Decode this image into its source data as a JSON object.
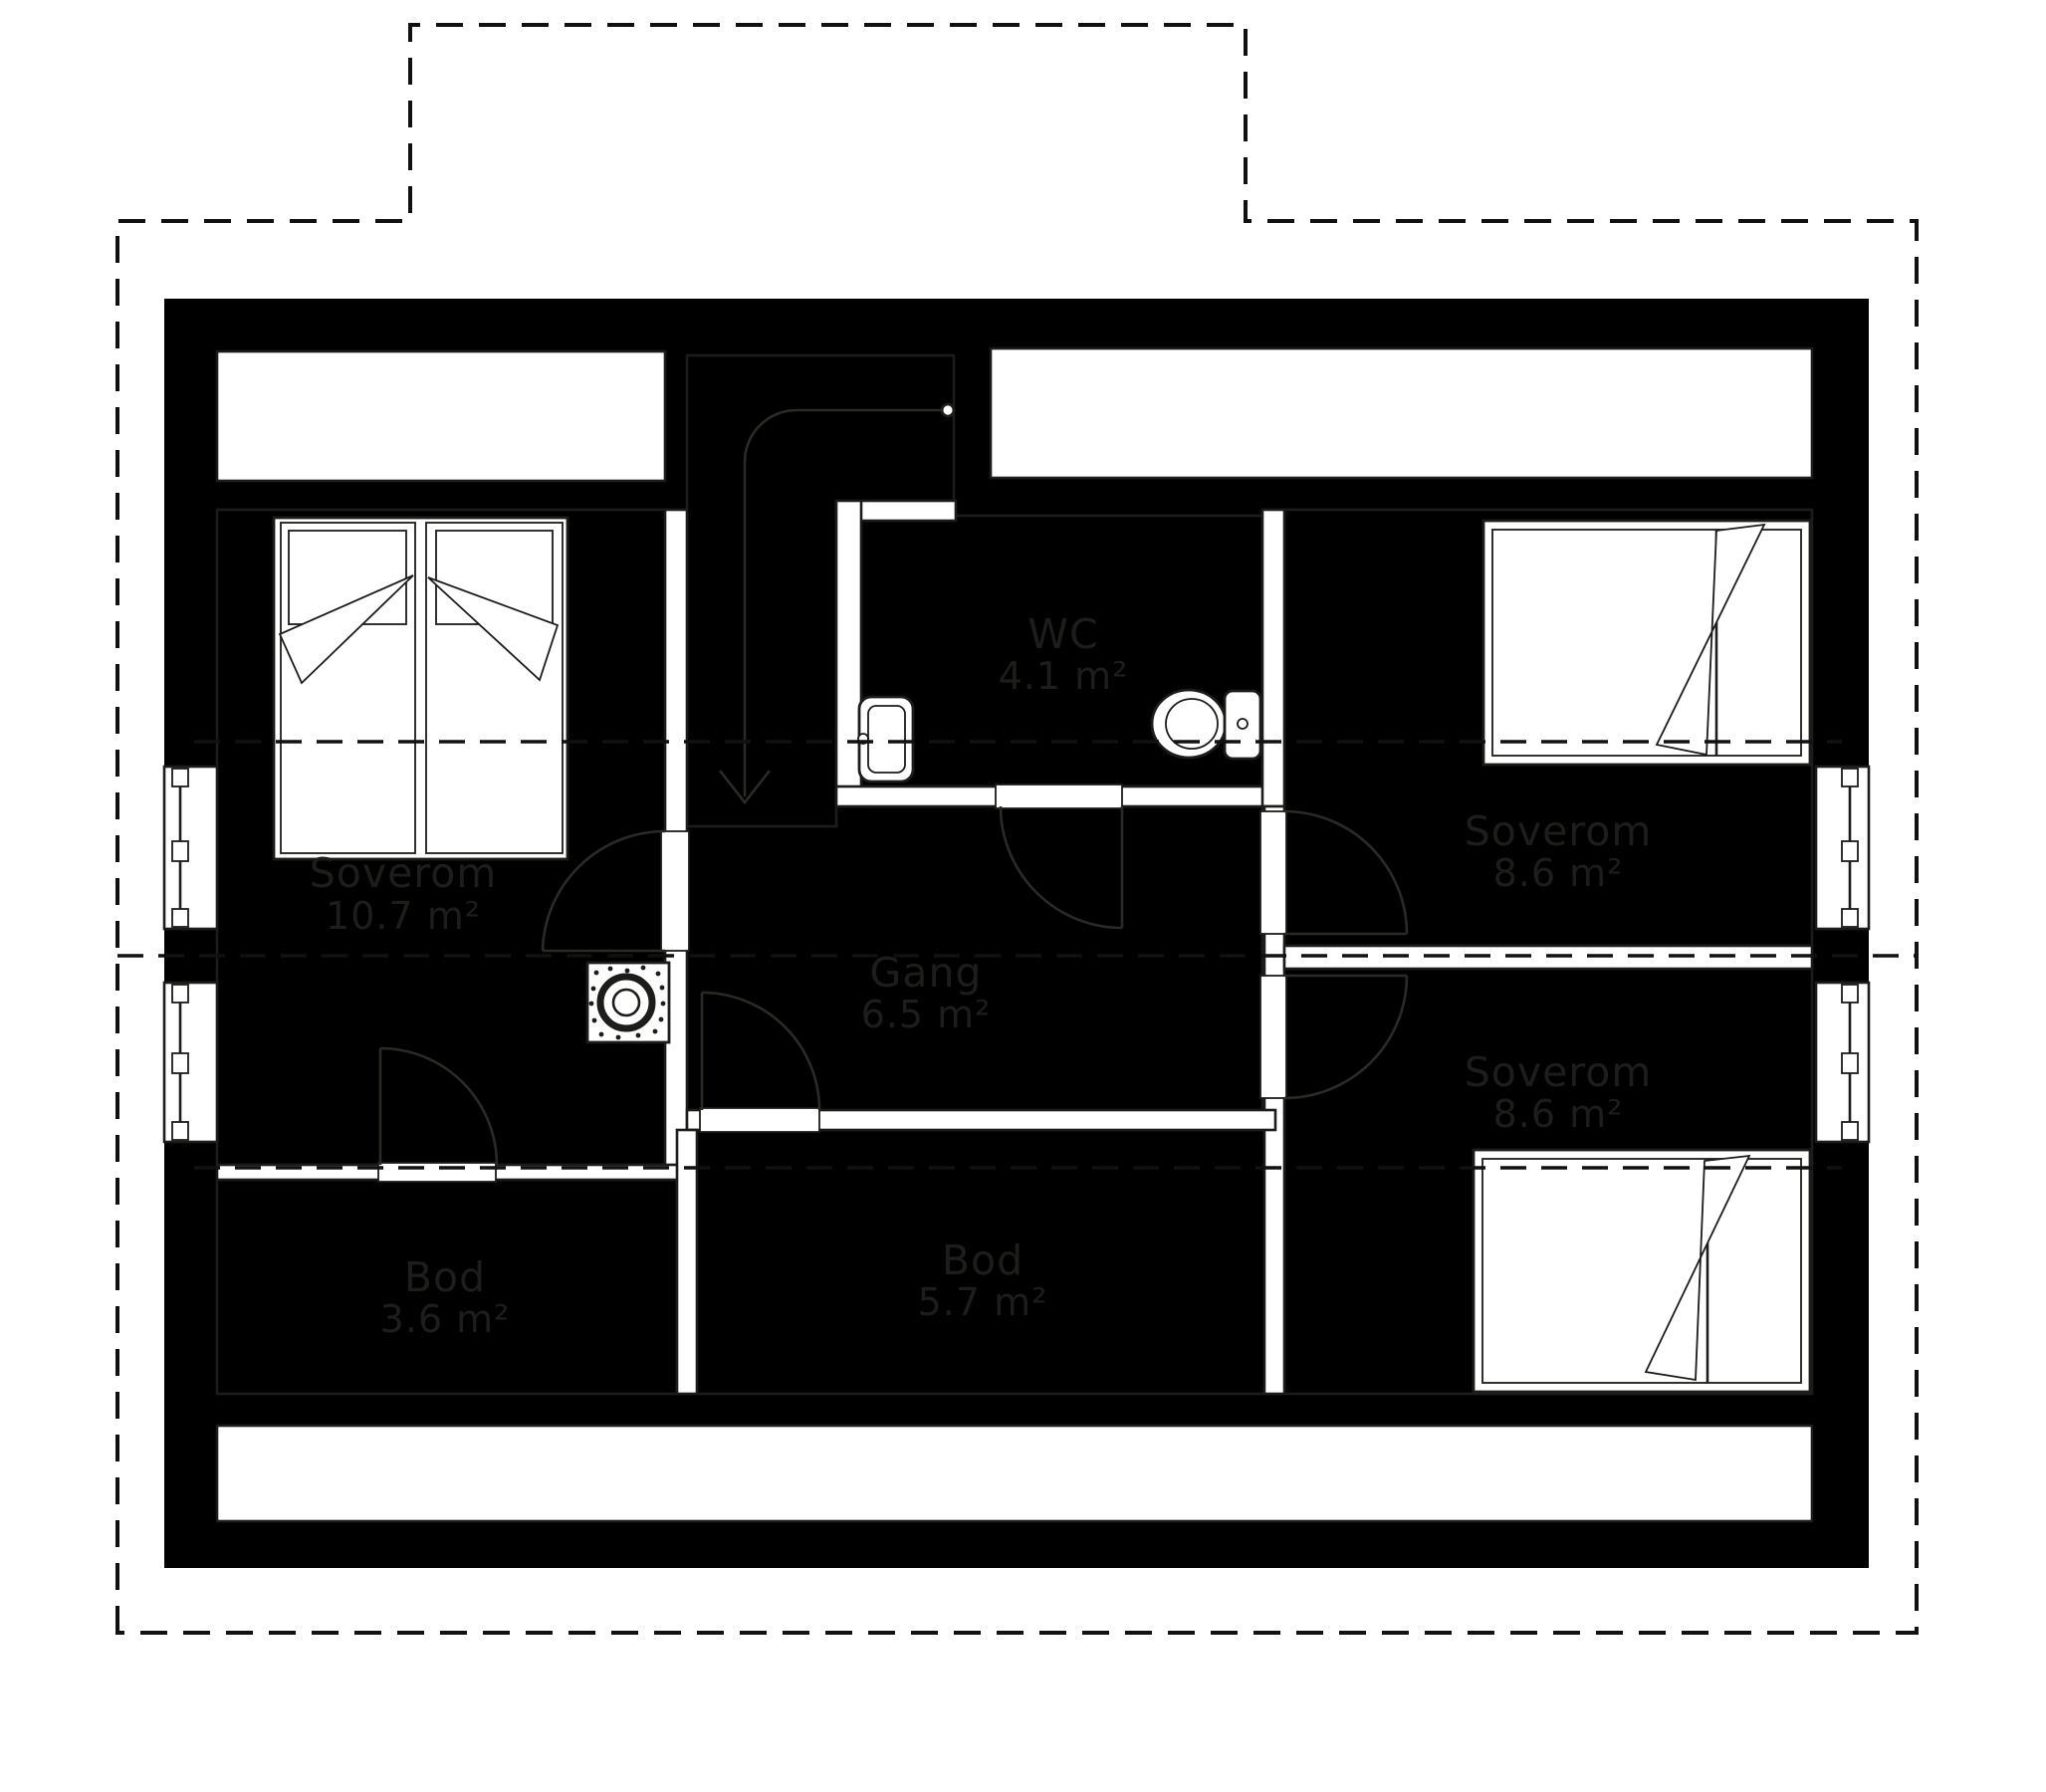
{
  "plan": {
    "type": "floor-plan",
    "rooms": {
      "soverom_left": {
        "name": "Soverom",
        "area": "10.7 m²"
      },
      "soverom_top_right": {
        "name": "Soverom",
        "area": "8.6 m²"
      },
      "soverom_bottom_right": {
        "name": "Soverom",
        "area": "8.6 m²"
      },
      "wc": {
        "name": "WC",
        "area": "4.1 m²"
      },
      "gang": {
        "name": "Gang",
        "area": "6.5 m²"
      },
      "bod_left": {
        "name": "Bod",
        "area": "3.6 m²"
      },
      "bod_center": {
        "name": "Bod",
        "area": "5.7 m²"
      }
    },
    "colors": {
      "bedroom_floor": "#f1c8a1",
      "storage_floor": "#93aed7",
      "wc_floor": "#cfe3f4",
      "hall_floor": "#f5e9da",
      "stair_floor": "#f3e4d2",
      "wall": "#000000"
    }
  }
}
